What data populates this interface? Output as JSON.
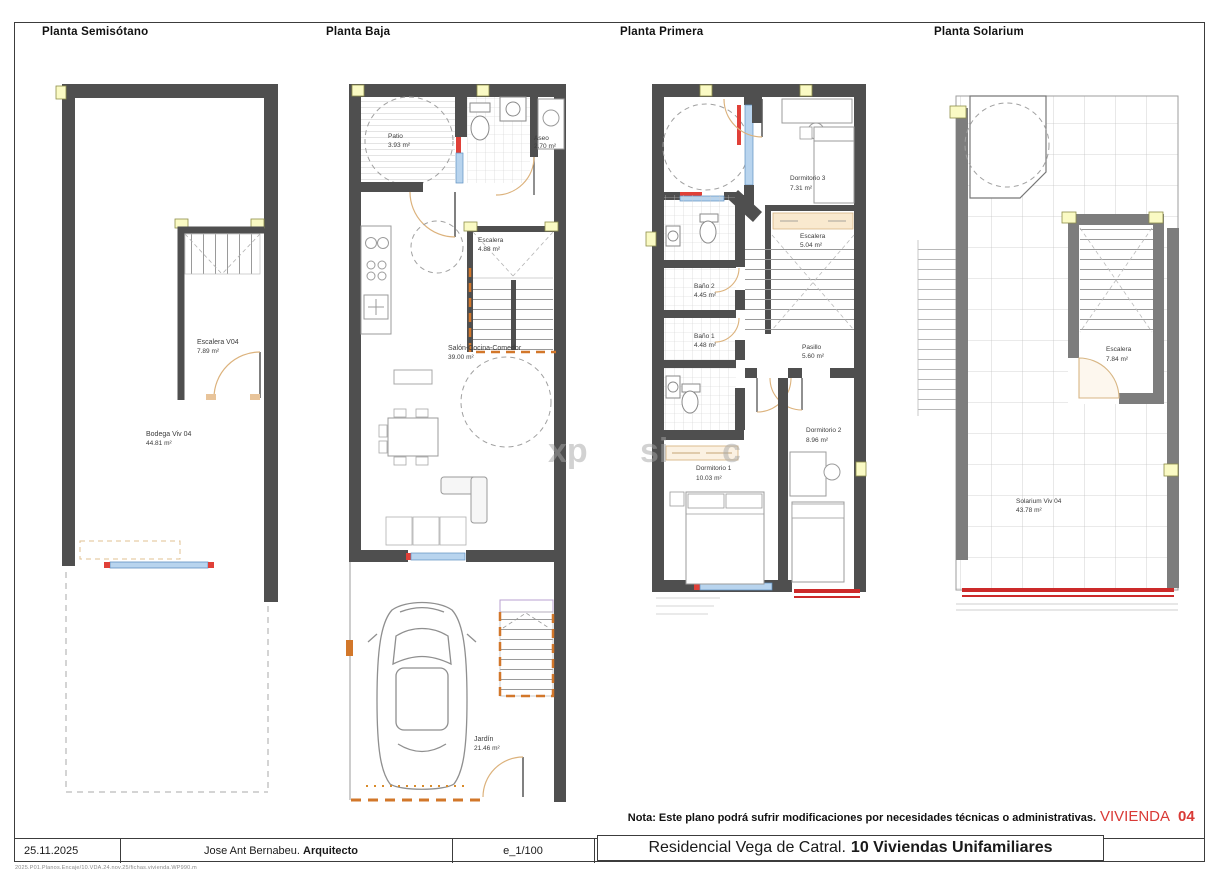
{
  "plans": {
    "semisotano": {
      "title": "Planta Semisótano",
      "escalera_name": "Escalera V04",
      "escalera_area": "7.89 m²",
      "bodega_name": "Bodega Viv 04",
      "bodega_area": "44.81 m²"
    },
    "baja": {
      "title": "Planta Baja",
      "patio_name": "Patio",
      "patio_area": "3.93 m²",
      "aseo_name": "Aseo",
      "aseo_area": "2.70 m²",
      "escalera_name": "Escalera",
      "escalera_area": "4.88 m²",
      "salon_name": "Salón-Cocina-Comedor",
      "salon_area": "39.00 m²",
      "jardin_name": "Jardín",
      "jardin_area": "21.46 m²"
    },
    "primera": {
      "title": "Planta Primera",
      "dorm3_name": "Dormitorio 3",
      "dorm3_area": "7.31 m²",
      "escalera_name": "Escalera",
      "escalera_area": "5.04 m²",
      "bano2_name": "Baño 2",
      "bano2_area": "4.45 m²",
      "bano1_name": "Baño 1",
      "bano1_area": "4.48 m²",
      "pasillo_name": "Pasillo",
      "pasillo_area": "5.60 m²",
      "dorm2_name": "Dormitorio 2",
      "dorm2_area": "8.96 m²",
      "dorm1_name": "Dormitorio 1",
      "dorm1_area": "10.03 m²"
    },
    "solarium": {
      "title": "Planta Solarium",
      "escalera_name": "Escalera",
      "escalera_area": "7.84 m²",
      "solarium_name": "Solarium Viv 04",
      "solarium_area": "43.78 m²"
    }
  },
  "titleblock": {
    "date": "25.11.2025",
    "architect_name": "Jose Ant Bernabeu.",
    "architect_role": "Arquitecto",
    "scale": "e_1/100",
    "project_name": "Residencial Vega de Catral.",
    "project_bold": "10 Viviendas Unifamiliares",
    "file_ref": "2025.P01.Planos.Encaje/10.VDA.24.nov.25/fichas.vivienda.WP990.m"
  },
  "note": {
    "text": "Nota: Este plano podrá sufrir modificaciones por necesidades técnicas o administrativas.",
    "vivienda_word": "VIVIENDA",
    "vivienda_number": "04"
  },
  "watermark": {
    "frag1": "xp",
    "frag2": "si",
    "frag3": "c"
  },
  "colors": {
    "wall": "#4f4f4f",
    "solarium_wall": "#7d7d7d",
    "red": "#d93a36",
    "window_blue": "#b8d4ee",
    "door_tan": "#dcb27c",
    "dash_orange": "#d2772a",
    "pad_yellow": "#fafac4"
  }
}
